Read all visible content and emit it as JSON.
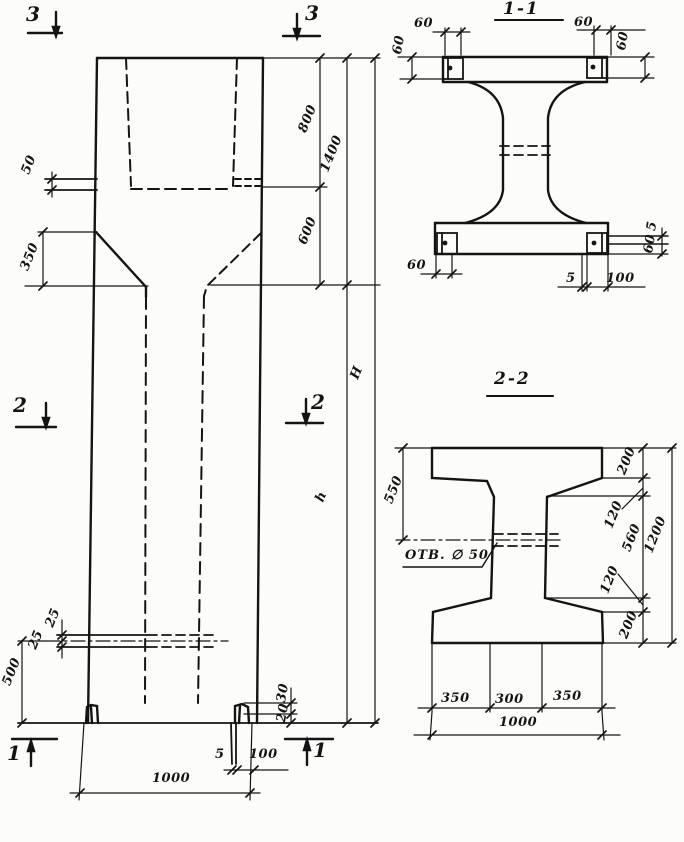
{
  "elevation": {
    "section_markers": {
      "m3": "3",
      "m2": "2",
      "m1": "1"
    },
    "dims": {
      "seg_800": "800",
      "seg_1400": "1400",
      "seg_600": "600",
      "shaft_height": "h",
      "total_height": "H",
      "ledge_50": "50",
      "taper_350": "350",
      "hole_upper_25": "25",
      "hole_lower_25": "25",
      "hole_level_500": "500",
      "notch_30": "30",
      "notch_20": "20",
      "plate_thk_5": "5",
      "plate_len_100": "100",
      "width_1000": "1000"
    }
  },
  "section_1_1": {
    "title": "1-1",
    "dims": {
      "top_left_60": "60",
      "left_60": "60",
      "top_right_60": "60",
      "right_60": "60",
      "bottom_left_60": "60",
      "bottom_5": "5",
      "bottom_100": "100",
      "side_5": "5",
      "side_60": "60"
    }
  },
  "section_2_2": {
    "title": "2-2",
    "hole_note": "ОТВ. ∅ 50",
    "dims": {
      "left_550": "550",
      "right_200_top": "200",
      "right_120_top": "120",
      "right_560": "560",
      "right_120_bottom": "120",
      "right_200_bottom": "200",
      "right_1200": "1200",
      "bottom_350_left": "350",
      "bottom_300": "300",
      "bottom_350_right": "350",
      "bottom_1000": "1000"
    }
  }
}
